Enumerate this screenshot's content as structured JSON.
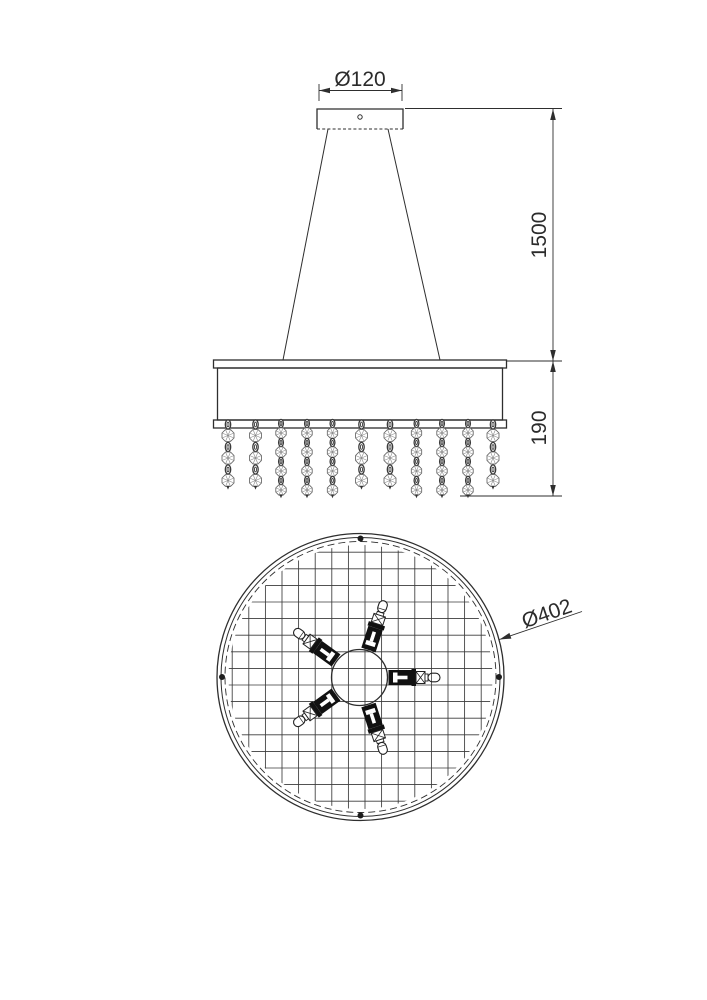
{
  "drawing": {
    "type": "technical-dimension-drawing",
    "subject": "crystal drum pendant chandelier, front elevation and bottom plan view",
    "colors": {
      "background": "#ffffff",
      "line": "#2e2e2e",
      "crystal_line": "#8a8a8a"
    },
    "labels": {
      "canopy_diameter": "Ø120",
      "suspension_drop": "1500",
      "shade_fringe_height": "190",
      "shade_diameter": "Ø402"
    },
    "front_view": {
      "crystal_strands": {
        "xs": [
          228,
          255.5,
          281,
          307,
          332.5,
          361.5,
          390,
          416.5,
          442,
          468,
          493
        ],
        "crystals_per_strand": [
          3,
          3,
          4,
          4,
          4,
          3,
          3,
          4,
          4,
          4,
          3
        ]
      },
      "suspension_wire_count": 2
    },
    "plan_view": {
      "lamp_count": 5,
      "lamp_angles_deg": [
        0,
        72,
        144,
        216,
        288
      ],
      "mount_dot_angles_deg": [
        0,
        90,
        180,
        270
      ],
      "grid_spacing_px": 16.6
    }
  }
}
